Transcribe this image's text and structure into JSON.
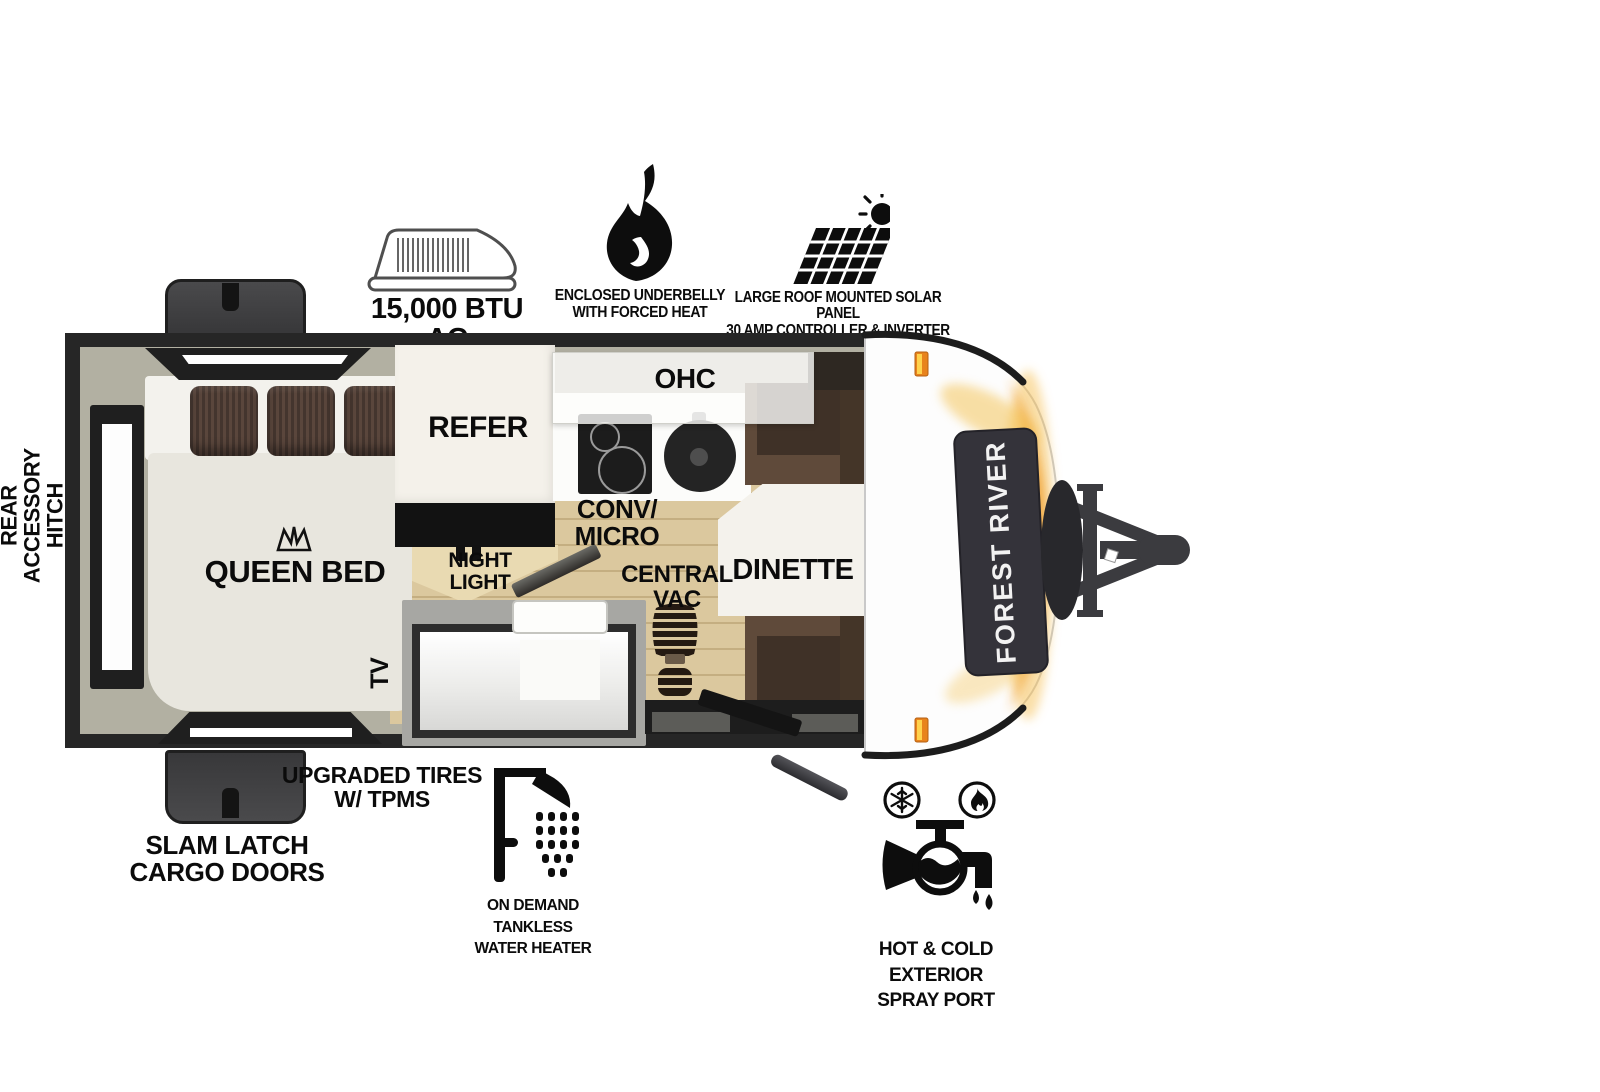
{
  "brand_badge": "FOREST RIVER",
  "callouts": {
    "ac": "15,000 BTU AC",
    "underbelly_1": "ENCLOSED UNDERBELLY",
    "underbelly_2": "WITH FORCED HEAT",
    "solar_1": "LARGE ROOF MOUNTED SOLAR PANEL",
    "solar_2": "30 AMP CONTROLLER & INVERTER PREP",
    "rear_hitch_1": "REAR",
    "rear_hitch_2": "ACCESSORY",
    "rear_hitch_3": "HITCH",
    "cargo_1": "SLAM LATCH",
    "cargo_2": "CARGO DOORS",
    "tires_1": "UPGRADED TIRES",
    "tires_2": "W/ TPMS",
    "heater_1": "ON DEMAND",
    "heater_2": "TANKLESS",
    "heater_3": "WATER HEATER",
    "spray_1": "HOT & COLD EXTERIOR",
    "spray_2": "SPRAY PORT"
  },
  "rooms": {
    "queen_bed": "QUEEN BED",
    "refer": "REFER",
    "ohc": "OHC",
    "conv_1": "CONV/",
    "conv_2": "MICRO",
    "night_1": "NIGHT",
    "night_2": "LIGHT",
    "vac_1": "CENTRAL",
    "vac_2": "VAC",
    "dinette": "DINETTE",
    "tv": "TV"
  },
  "colors": {
    "accent_orange": "#f0a032",
    "wall_dark": "#262626",
    "floor_wood": "#d9c69c",
    "bench_brown": "#5f4a3a",
    "marker_light": "#e8831d"
  }
}
